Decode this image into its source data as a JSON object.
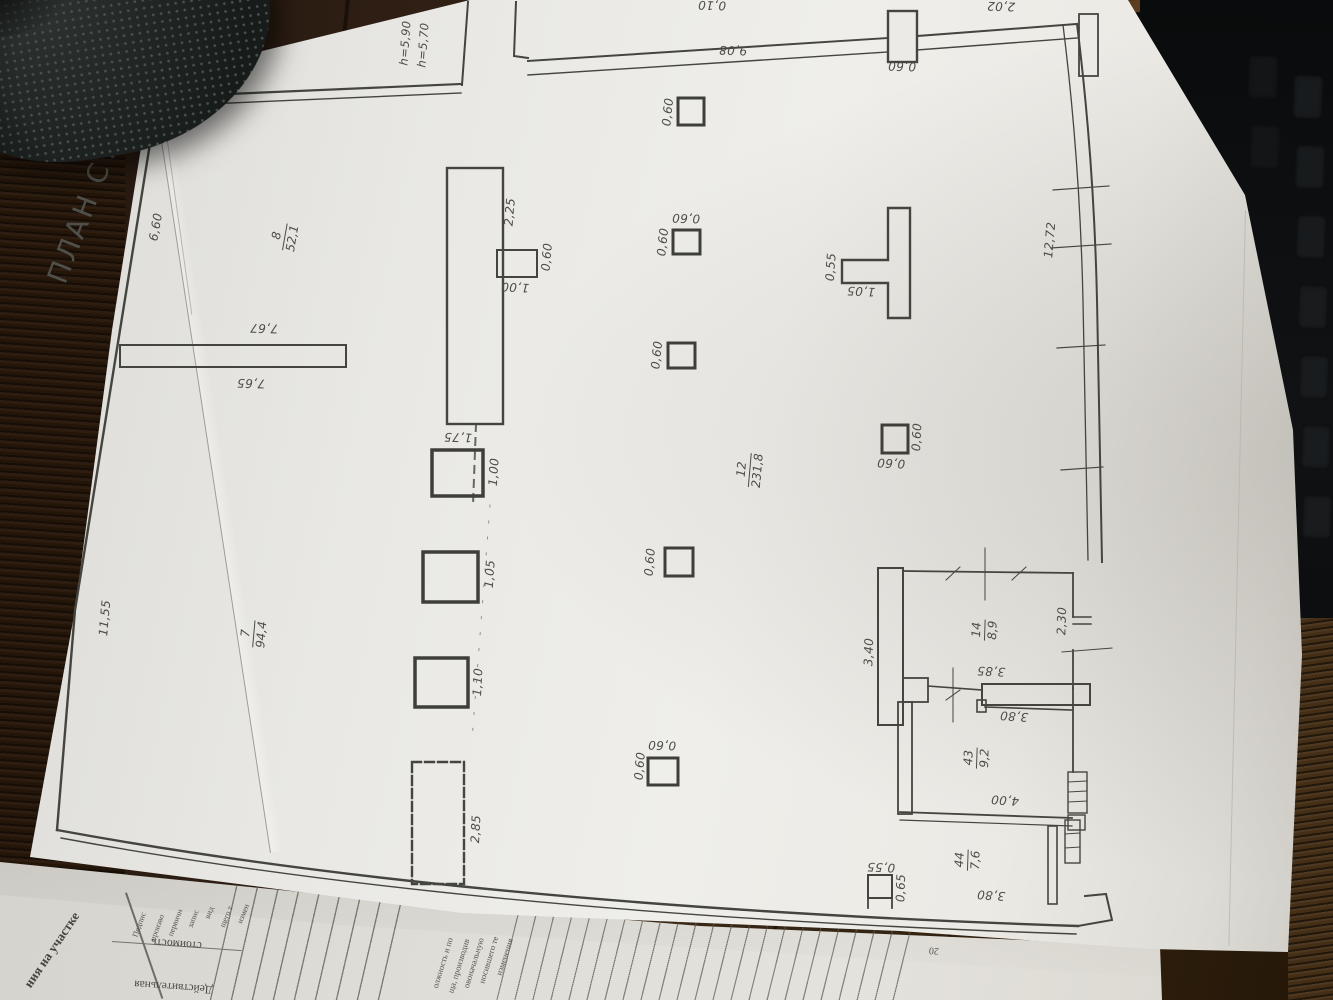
{
  "title": "ПЛАН СТРОЕ",
  "heights": [
    "h=5,90",
    "h=5,70"
  ],
  "dims": [
    "6,60",
    "7,67",
    "7,65",
    "11,55",
    "2,25",
    "0,60",
    "1,00",
    "9,08",
    "0,60",
    "12,72",
    "0,55",
    "1,05",
    "0,60",
    "0,60",
    "0,60",
    "0,60",
    "0,60",
    "0,60",
    "0,60",
    "0,60",
    "0,60",
    "1,75",
    "1,00",
    "1,05",
    "1,10",
    "2,85",
    "3,40",
    "2,30",
    "3,85",
    "3,80",
    "4,00",
    "0,55",
    "0,65",
    "3,80",
    "0,10",
    "2,02"
  ],
  "rooms": [
    {
      "num": "8",
      "area": "52,1"
    },
    {
      "num": "7",
      "area": "94,4"
    },
    {
      "num": "12",
      "area": "231,8"
    },
    {
      "num": "14",
      "area": "8,9"
    },
    {
      "num": "43",
      "area": "9,2"
    },
    {
      "num": "44",
      "area": "7,6"
    }
  ],
  "under_page": {
    "left_partial": "ния на участке",
    "col1_line1": "Действительная",
    "col1_line2": "стоимость",
    "col1_header_words": [
      "Подпис",
      "произво",
      "первичн",
      "запис",
      "вид",
      "щего т",
      "измен"
    ],
    "col2_header_lines": [
      "олжность и по",
      "ща, производив",
      "овоначальную",
      "носившего те",
      "изменения"
    ],
    "page_number_partial": "20"
  },
  "colors": {
    "paper": "#e9e8e4",
    "ink": "#4d4d46",
    "wood": "#2f1f14",
    "object": "#202422"
  }
}
